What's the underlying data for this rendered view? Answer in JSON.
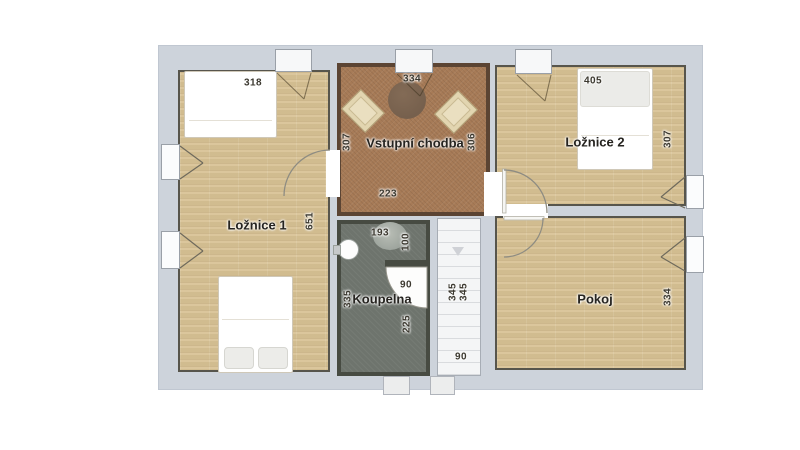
{
  "plan": {
    "title": "Vstupní chodba",
    "rooms": {
      "loznice1": {
        "label": "Ložnice 1",
        "dims": {
          "top": "318",
          "height": "651"
        }
      },
      "chodba": {
        "label": "Vstupní chodba",
        "dims": {
          "top": "334",
          "left": "307",
          "right": "306",
          "bottom": "223"
        }
      },
      "loznice2": {
        "label": "Ložnice 2",
        "dims": {
          "top": "405",
          "right": "307"
        }
      },
      "koupelna": {
        "label": "Koupelna",
        "dims": {
          "top": "193",
          "upper_right": "100",
          "door": "90",
          "left": "335",
          "lower_right": "225"
        }
      },
      "stairs": {
        "dims": {
          "run1": "345",
          "run2": "345",
          "width": "90"
        }
      },
      "pokoj": {
        "label": "Pokoj",
        "dims": {
          "right": "334"
        }
      }
    },
    "colors": {
      "wood": "#d8c294",
      "hall_floor": "#a77b57",
      "hall_wall": "#5b4433",
      "bath_floor": "#6e746d",
      "bath_wall": "#474b42",
      "band": "#cdd3db",
      "wall": "#57554c",
      "stairs": "#f4f5f6",
      "step_line": "#d9dbde",
      "chair": "#e2d5b0",
      "chair_border": "#b3a278",
      "table": "#76604d",
      "text": "#3b382f"
    }
  }
}
